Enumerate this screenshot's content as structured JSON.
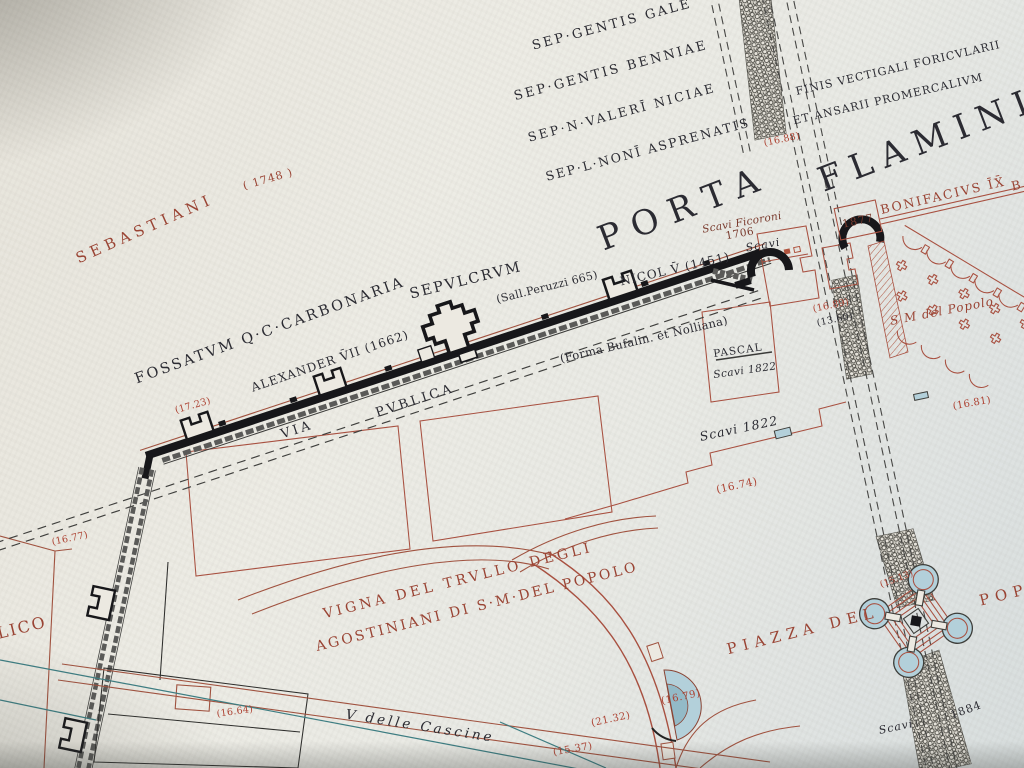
{
  "palette": {
    "paper": "#eae7e0",
    "ink": "#2b2b32",
    "redLabel": "#9a4434",
    "sepia": "#7a3b2e",
    "elevRed": "#ad4232",
    "outlineRed": "#a85040",
    "roadRed": "#a0523f",
    "wallBlack": "#17171a",
    "wallGray": "#5a5a58",
    "water": "#b3d0da",
    "waterDeep": "#93bac7",
    "teal": "#3d7d82"
  },
  "map": {
    "labels": [
      {
        "n": "label-sep-gentis-gale",
        "t": "SEP·GENTIS GALE",
        "x": 612,
        "y": 25,
        "r": -15,
        "s": 13,
        "ls": 2.5,
        "c": "ink"
      },
      {
        "n": "label-sep-gentis-benniae",
        "t": "SEP·GENTIS BENNIAE",
        "x": 611,
        "y": 71,
        "r": -15,
        "s": 13,
        "ls": 2.5,
        "c": "ink"
      },
      {
        "n": "label-sep-valeri-niciae",
        "t": "SEP·N·VALERĪ NICIAE",
        "x": 622,
        "y": 113,
        "r": -15,
        "s": 12.5,
        "ls": 2.5,
        "c": "ink"
      },
      {
        "n": "label-sep-noni-asprenatis",
        "t": "SEP·L·NONĪ ASPRENATIS",
        "x": 648,
        "y": 150,
        "r": -15,
        "s": 12.5,
        "ls": 2,
        "c": "ink"
      },
      {
        "n": "label-finis-vectigali",
        "t": "FINIS VECTIGALI FORICVLARII",
        "x": 898,
        "y": 68,
        "r": -13,
        "s": 11,
        "ls": 1,
        "c": "ink"
      },
      {
        "n": "label-et-ansarii",
        "t": "ET ANSARII PROMERCALIVM",
        "x": 888,
        "y": 99,
        "r": -13,
        "s": 11,
        "ls": 1,
        "c": "ink"
      },
      {
        "n": "label-porta",
        "t": "PORTA",
        "x": 684,
        "y": 208,
        "r": -21,
        "s": 34,
        "ls": 12,
        "c": "ink"
      },
      {
        "n": "label-flaminia",
        "t": "FLAMINIA",
        "x": 944,
        "y": 134,
        "r": -21,
        "s": 34,
        "ls": 10,
        "c": "ink"
      },
      {
        "n": "label-sebastiani",
        "t": "SEBASTIANI",
        "x": 145,
        "y": 229,
        "r": -24,
        "s": 15,
        "ls": 5,
        "c": "red"
      },
      {
        "n": "label-sebastiani-date",
        "t": "( 1748 )",
        "x": 268,
        "y": 179,
        "r": -16,
        "s": 11,
        "ls": 1,
        "c": "red"
      },
      {
        "n": "label-fossatum-carbonaria",
        "t": "FOSSATVM Q·C·CARBONARIA",
        "x": 270,
        "y": 331,
        "r": -20,
        "s": 14.5,
        "ls": 2.5,
        "c": "ink"
      },
      {
        "n": "label-sepulcrum",
        "t": "SEPVLCRVM",
        "x": 466,
        "y": 281,
        "r": -14,
        "s": 14.5,
        "ls": 2,
        "c": "ink"
      },
      {
        "n": "label-sall-peruzzi",
        "t": "(Sall.Peruzzi 665)",
        "x": 547,
        "y": 287,
        "r": -14,
        "s": 11,
        "ls": 0.3,
        "c": "ink"
      },
      {
        "n": "label-nicol-v",
        "t": "NICOL V̄ (1451)",
        "x": 675,
        "y": 269,
        "r": -13,
        "s": 12,
        "ls": 1,
        "c": "ink"
      },
      {
        "n": "label-alexander-vii",
        "t": "ALEXANDER V̄II (1662)",
        "x": 330,
        "y": 361,
        "r": -19,
        "s": 12,
        "ls": 1,
        "c": "ink"
      },
      {
        "n": "label-via",
        "t": "VIA",
        "x": 297,
        "y": 430,
        "r": -18,
        "s": 13,
        "ls": 3,
        "c": "ink"
      },
      {
        "n": "label-pvblica",
        "t": "PVBLICA",
        "x": 415,
        "y": 401,
        "r": -18,
        "s": 13,
        "ls": 3,
        "c": "ink"
      },
      {
        "n": "label-forma-bufalin",
        "t": "(Forma Bufalin. et Nolliana)",
        "x": 644,
        "y": 340,
        "r": -13,
        "s": 11.5,
        "ls": 0.3,
        "c": "ink"
      },
      {
        "n": "label-pascal",
        "t": "PASCAL",
        "x": 738,
        "y": 351,
        "r": -8,
        "s": 10.5,
        "ls": 1,
        "c": "ink"
      },
      {
        "n": "label-pascal-scavi-1822",
        "t": "Scavi 1822",
        "x": 745,
        "y": 371,
        "r": -8,
        "s": 10.5,
        "ls": 0.5,
        "c": "ink",
        "i": 1
      },
      {
        "n": "label-scavi-1822",
        "t": "Scavi 1822",
        "x": 739,
        "y": 429,
        "r": -12,
        "s": 12.5,
        "ls": 1,
        "c": "ink",
        "i": 1
      },
      {
        "n": "label-scavi-ficoroni",
        "t": "Scavi Ficoroni",
        "x": 742,
        "y": 223,
        "r": -10,
        "s": 10.5,
        "ls": 0.3,
        "c": "sep",
        "i": 1
      },
      {
        "n": "label-ficoroni-1706",
        "t": "1706",
        "x": 740,
        "y": 234,
        "r": -10,
        "s": 10.5,
        "ls": 0.5,
        "c": "sep"
      },
      {
        "n": "label-scavi-gate",
        "t": "Scavi",
        "x": 763,
        "y": 245,
        "r": -10,
        "s": 11,
        "ls": 1,
        "c": "ink",
        "i": 1
      },
      {
        "n": "label-bonifacivs",
        "t": "BONIFACIVS ĪX̄",
        "x": 943,
        "y": 196,
        "r": -13,
        "s": 12.5,
        "ls": 2,
        "c": "red"
      },
      {
        "n": "label-b-cut",
        "t": "B",
        "x": 1016,
        "y": 186,
        "r": -13,
        "s": 12.5,
        "ls": 0,
        "c": "red"
      },
      {
        "n": "label-1877",
        "t": "1877",
        "x": 858,
        "y": 221,
        "r": -12,
        "s": 11,
        "ls": 1,
        "c": "sep"
      },
      {
        "n": "label-sm-del-popolo",
        "t": "S M del Popolo",
        "x": 942,
        "y": 311,
        "r": -11,
        "s": 12,
        "ls": 1,
        "c": "red",
        "i": 1
      },
      {
        "n": "label-elev-16-81",
        "t": "(16.81)",
        "x": 972,
        "y": 404,
        "r": -10,
        "s": 10,
        "ls": 0.3,
        "c": "elev"
      },
      {
        "n": "label-vigna-line1",
        "t": "VIGNA DEL TRVLLO DEGLI",
        "x": 458,
        "y": 581,
        "r": -14,
        "s": 14,
        "ls": 3.5,
        "c": "red"
      },
      {
        "n": "label-vigna-line2",
        "t": "AGOSTINIANI DI S·M·DEL POPOLO",
        "x": 477,
        "y": 607,
        "r": -14,
        "s": 14,
        "ls": 2.5,
        "c": "red"
      },
      {
        "n": "label-piazza-del",
        "t": "PIAZZA DEL",
        "x": 803,
        "y": 631,
        "r": -14,
        "s": 15,
        "ls": 6,
        "c": "red"
      },
      {
        "n": "label-popolo-cut",
        "t": "POPO",
        "x": 1013,
        "y": 593,
        "r": -14,
        "s": 15,
        "ls": 6,
        "c": "red"
      },
      {
        "n": "label-v-delle-cascine",
        "t": "V delle Cascine",
        "x": 420,
        "y": 727,
        "r": 9,
        "s": 13.5,
        "ls": 3,
        "c": "ink",
        "i": 1
      },
      {
        "n": "label-elev-16-88",
        "t": "(16.88)",
        "x": 782,
        "y": 140,
        "r": -12,
        "s": 9.5,
        "ls": 0.3,
        "c": "elev"
      },
      {
        "n": "label-elev-16-89",
        "t": "(16.89)",
        "x": 831,
        "y": 306,
        "r": -12,
        "s": 9.5,
        "ls": 0.3,
        "c": "elev"
      },
      {
        "n": "label-elev-13-60",
        "t": "(13.60)",
        "x": 835,
        "y": 320,
        "r": -12,
        "s": 9.5,
        "ls": 0.3,
        "c": "ink"
      },
      {
        "n": "label-elev-15-13",
        "t": "(15.13)",
        "x": 897,
        "y": 580,
        "r": -20,
        "s": 9,
        "ls": 0.3,
        "c": "elev"
      },
      {
        "n": "label-elev-16-74",
        "t": "(16.74)",
        "x": 737,
        "y": 486,
        "r": -12,
        "s": 10.5,
        "ls": 0.5,
        "c": "elev"
      },
      {
        "n": "label-elev-16-79",
        "t": "(16.79)",
        "x": 681,
        "y": 698,
        "r": -12,
        "s": 10,
        "ls": 0.5,
        "c": "elev"
      },
      {
        "n": "label-elev-21-32",
        "t": "(21.32)",
        "x": 611,
        "y": 720,
        "r": -12,
        "s": 10,
        "ls": 0.5,
        "c": "elev"
      },
      {
        "n": "label-elev-15-37",
        "t": "(15.37)",
        "x": 573,
        "y": 750,
        "r": -10,
        "s": 10,
        "ls": 0.5,
        "c": "elev"
      },
      {
        "n": "label-elev-16-64",
        "t": "(16.64)",
        "x": 235,
        "y": 712,
        "r": -8,
        "s": 9.5,
        "ls": 0.3,
        "c": "elev"
      },
      {
        "n": "label-elev-16-77",
        "t": "(16.77)",
        "x": 70,
        "y": 539,
        "r": -12,
        "s": 9.5,
        "ls": 0.3,
        "c": "elev"
      },
      {
        "n": "label-elev-17-23",
        "t": "(17.23)",
        "x": 193,
        "y": 406,
        "r": -16,
        "s": 9.5,
        "ls": 0.3,
        "c": "elev"
      },
      {
        "n": "label-lico",
        "t": "LICO",
        "x": 22,
        "y": 628,
        "r": -14,
        "s": 16,
        "ls": 2,
        "c": "red"
      },
      {
        "n": "label-scavi-1884",
        "t": "Scavi",
        "x": 896,
        "y": 727,
        "r": -12,
        "s": 11,
        "ls": 1,
        "c": "ink",
        "i": 1
      },
      {
        "n": "label-1884",
        "t": "1884",
        "x": 966,
        "y": 710,
        "r": -20,
        "s": 11,
        "ls": 1,
        "c": "ink"
      }
    ]
  }
}
